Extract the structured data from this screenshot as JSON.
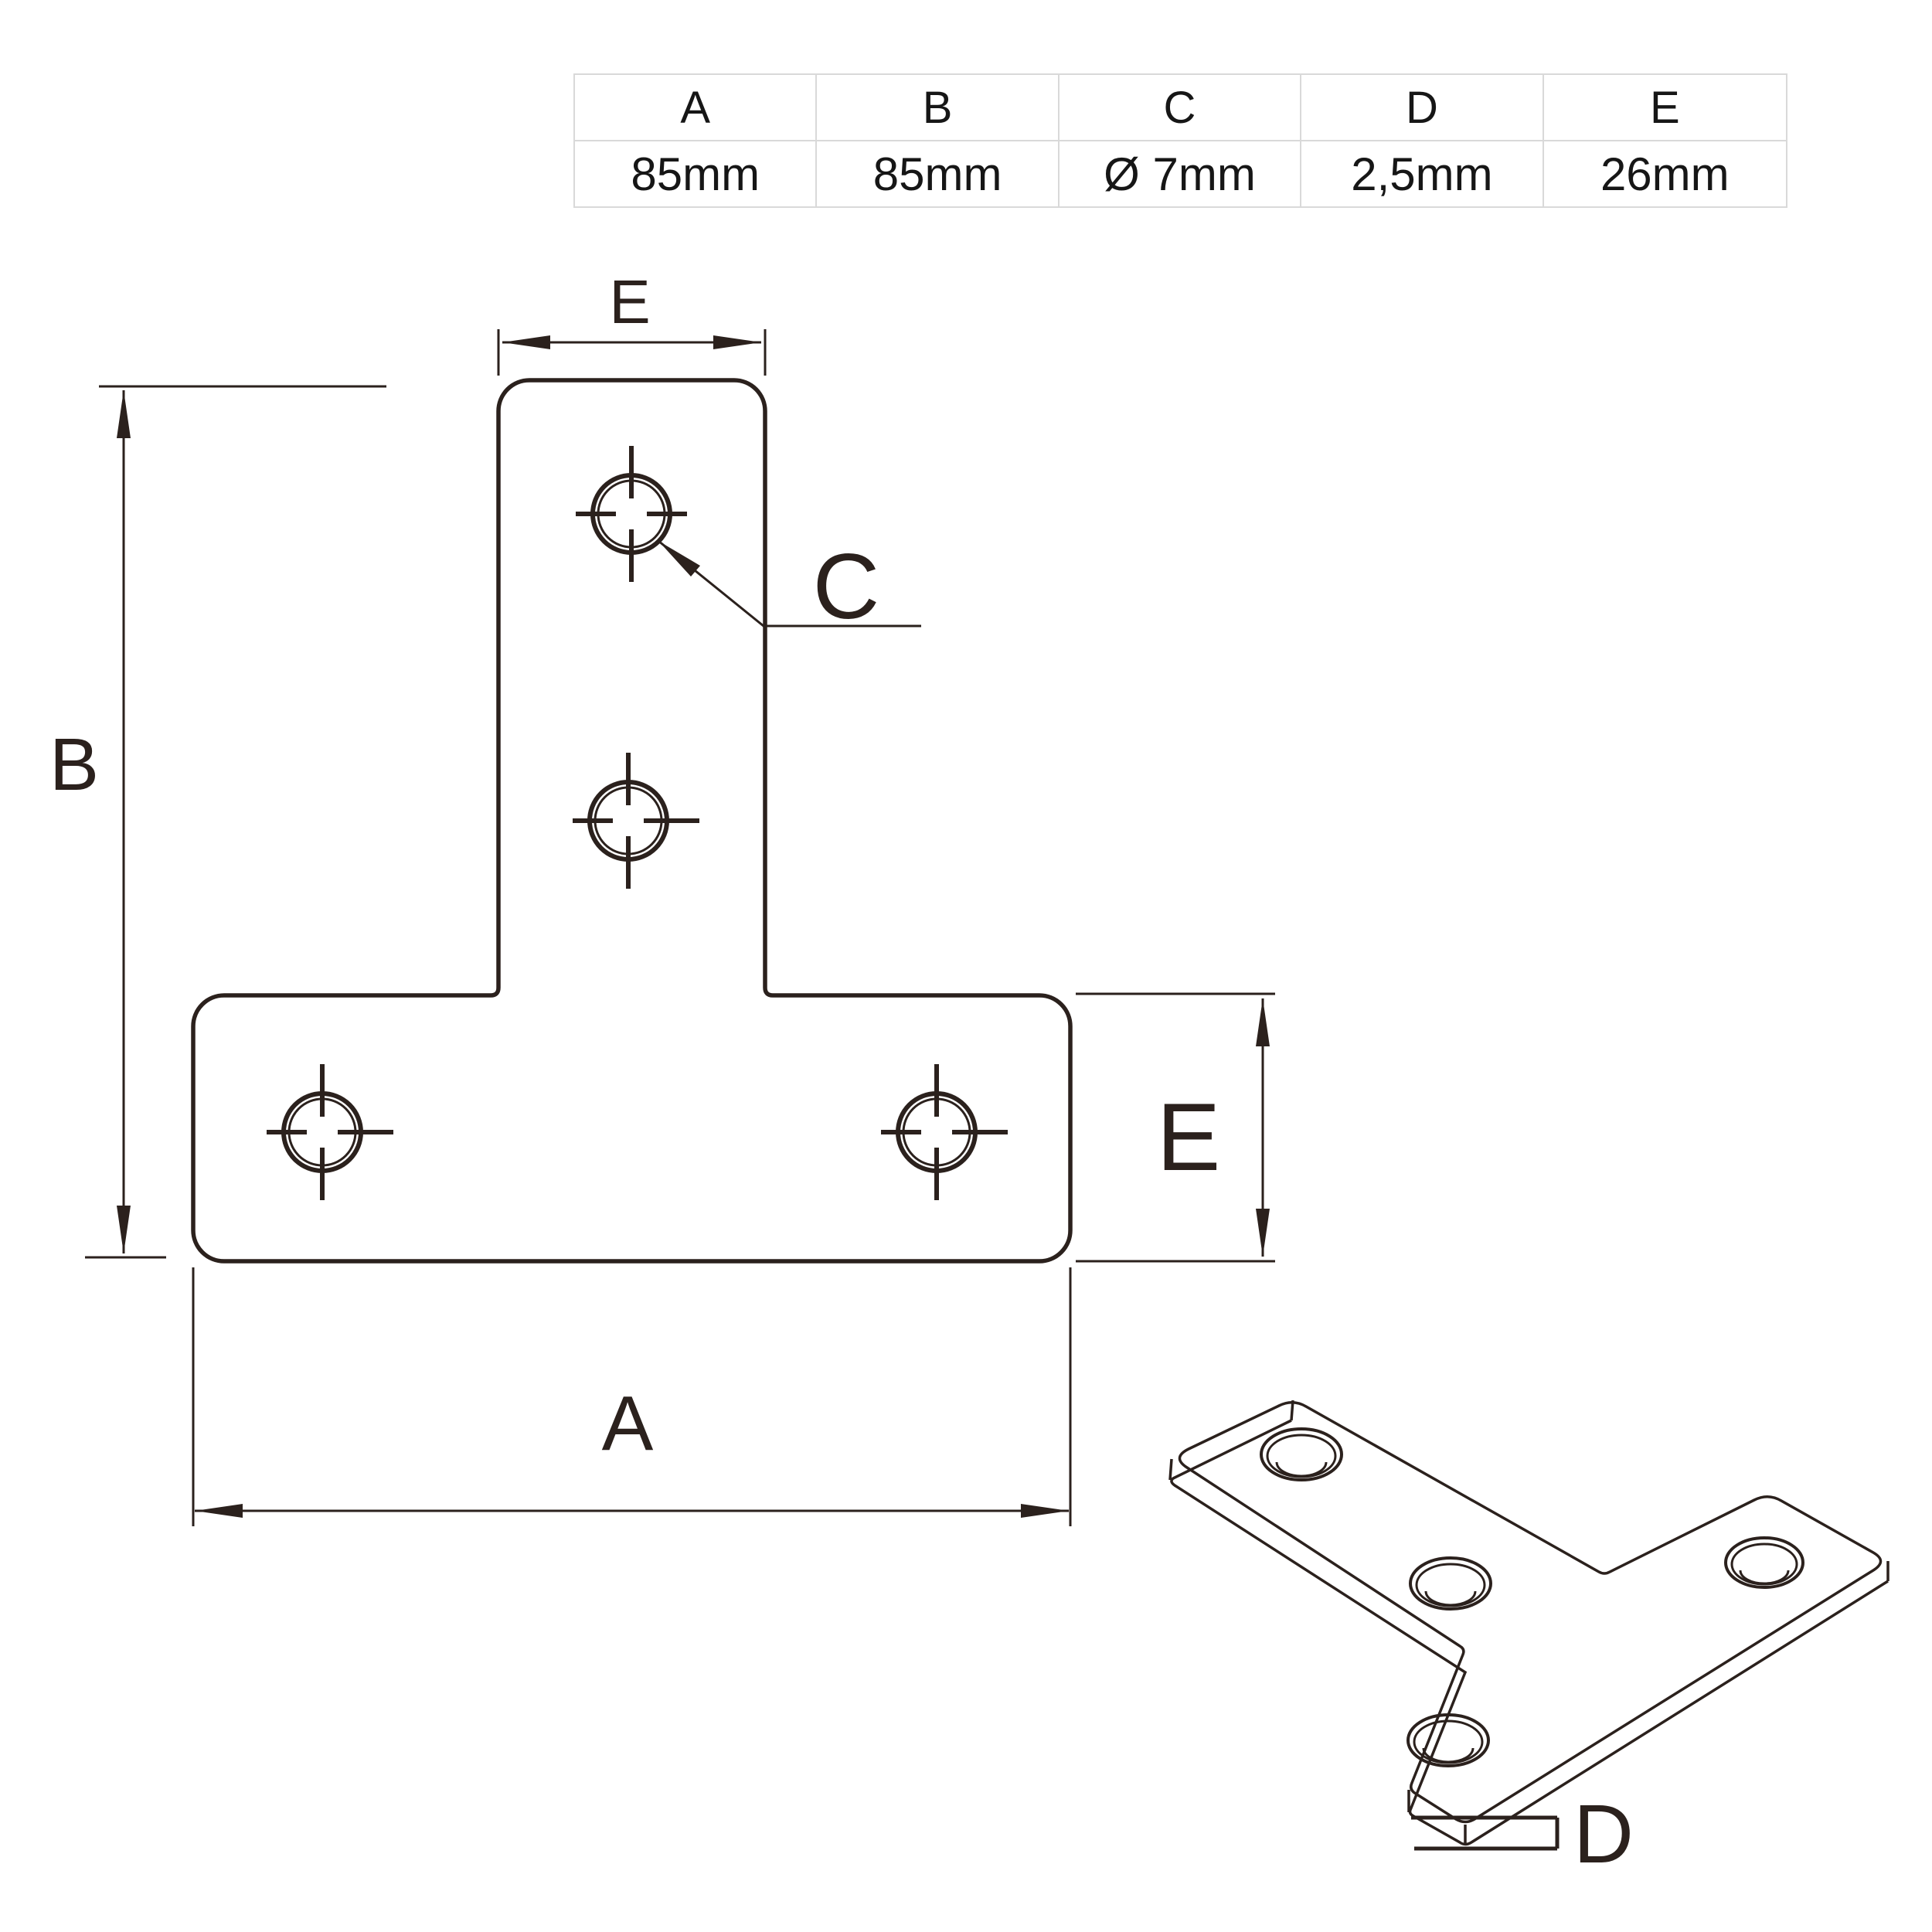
{
  "colors": {
    "line": "#2b211d",
    "table_border": "#d9d9d9",
    "text": "#161616",
    "background": "#ffffff"
  },
  "spec_table": {
    "columns": [
      {
        "header": "A",
        "value": "85mm"
      },
      {
        "header": "B",
        "value": "85mm"
      },
      {
        "header": "C",
        "value": "Ø 7mm"
      },
      {
        "header": "D",
        "value": "2,5mm"
      },
      {
        "header": "E",
        "value": "26mm"
      }
    ]
  },
  "front_view": {
    "labels": {
      "stem_width_top": "E",
      "overall_height_left": "B",
      "hole_callout": "C",
      "overall_width_bottom": "A",
      "bar_height_right": "E"
    }
  },
  "iso_view": {
    "labels": {
      "thickness": "D"
    }
  }
}
